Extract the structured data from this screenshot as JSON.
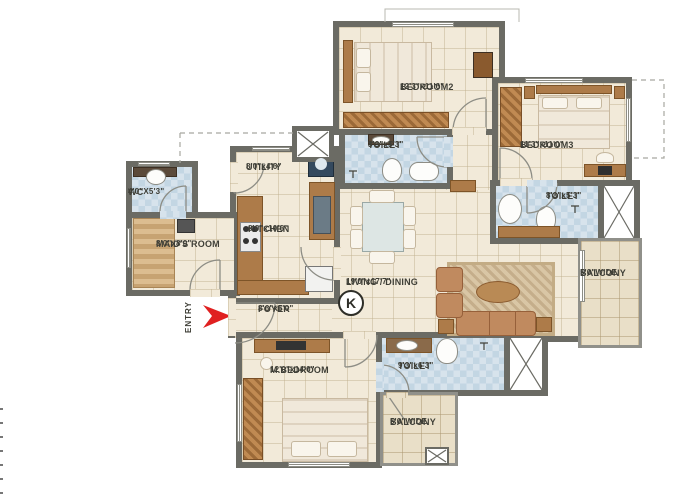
{
  "plan": {
    "entry_label": "ENTRY",
    "compass_label": "K"
  },
  "rooms": {
    "bedroom2": {
      "name": "BEDROOM2",
      "dims": "12'3\"x11'6\""
    },
    "bedroom3": {
      "name": "BEDROOM3",
      "dims": "11'3\"x11'0\""
    },
    "toilet_top": {
      "name": "TOILET",
      "dims": "8'3\"x5'3\""
    },
    "toilet_right": {
      "name": "TOILET",
      "dims": "8'3\"x5'3\""
    },
    "toilet_bottom": {
      "name": "TOILET",
      "dims": "9'3\"x6'3\""
    },
    "balcony_right": {
      "name": "BALCONY",
      "dims": "5'0\"WIDE"
    },
    "balcony_bottom": {
      "name": "BALCONY",
      "dims": "5'0\"WIDE"
    },
    "wc": {
      "name": "WC",
      "dims": "4'0\"X5'3\""
    },
    "maids_room": {
      "name": "MAID'S ROOM",
      "dims": "8'0\"x8'0\""
    },
    "utility": {
      "name": "UTILITY",
      "dims": "8'0\"x4'6\""
    },
    "kitchen": {
      "name": "KITCHEN",
      "dims": "8'0\"x10'6\""
    },
    "living_dining": {
      "name": "LIVING / DINING",
      "dims": "19'0\"x17'7\""
    },
    "foyer": {
      "name": "FOYER",
      "dims": "8'6\"x5'0\""
    },
    "m_bedroom": {
      "name": "M.BEDROOM",
      "dims": "12'0\"x14'0\""
    }
  },
  "colors": {
    "wall": "#6b6b64",
    "floor": "#f2ead9",
    "toilet_tile": "#cfdfe9",
    "balcony_tile": "#e9dfc8",
    "wood": "#ad7b49",
    "entry_arrow": "#e02020"
  }
}
